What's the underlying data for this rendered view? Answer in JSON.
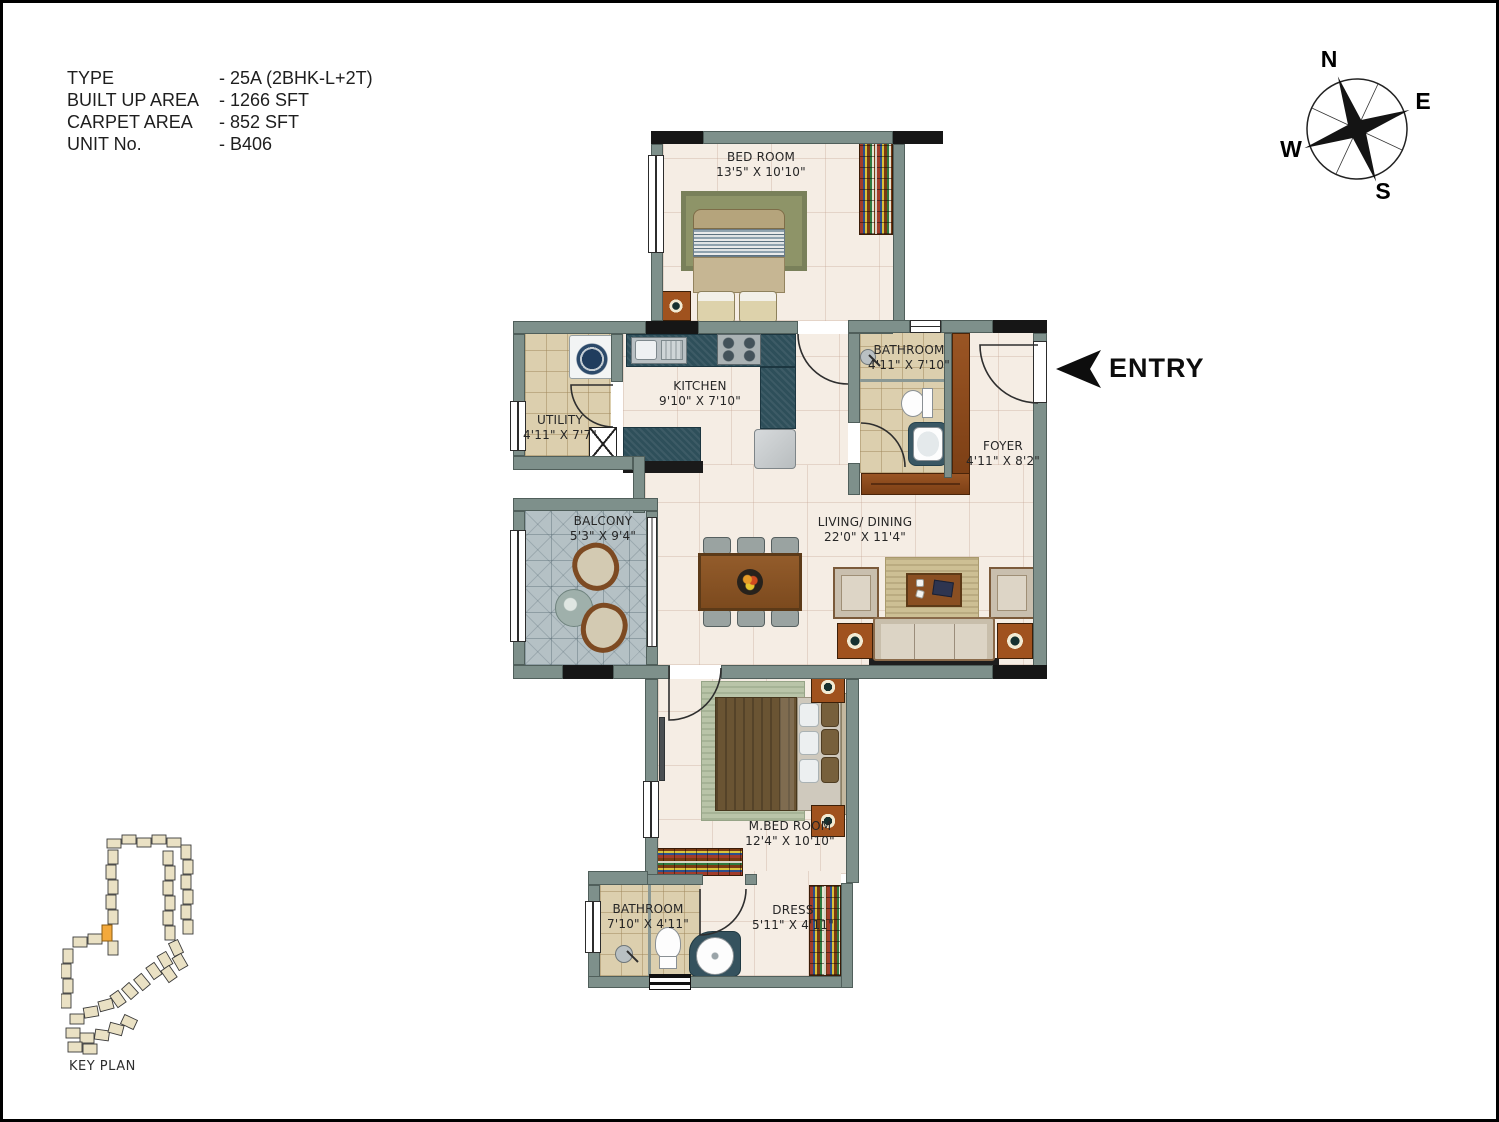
{
  "unit_info": {
    "rows": [
      {
        "label": "TYPE",
        "value": "- 25A (2BHK-L+2T)"
      },
      {
        "label": "BUILT UP AREA",
        "value": "- 1266 SFT"
      },
      {
        "label": "CARPET AREA",
        "value": "- 852 SFT"
      },
      {
        "label": "UNIT No.",
        "value": "- B406"
      }
    ]
  },
  "compass": {
    "north": "N",
    "east": "E",
    "west": "W",
    "south": "S"
  },
  "entry": {
    "label": "ENTRY"
  },
  "key_plan": {
    "label": "KEY PLAN"
  },
  "rooms": [
    {
      "id": "bedroom",
      "name": "BED ROOM",
      "dims": "13'5\" X 10'10\""
    },
    {
      "id": "kitchen",
      "name": "KITCHEN",
      "dims": "9'10\" X 7'10\""
    },
    {
      "id": "utility",
      "name": "UTILITY",
      "dims": "4'11\" X 7'7\""
    },
    {
      "id": "bathroom-top",
      "name": "BATHROOM",
      "dims": "4'11\" X 7'10\""
    },
    {
      "id": "foyer",
      "name": "FOYER",
      "dims": "4'11\" X 8'2\""
    },
    {
      "id": "balcony",
      "name": "BALCONY",
      "dims": "5'3\" X 9'4\""
    },
    {
      "id": "living-dining",
      "name": "LIVING/ DINING",
      "dims": "22'0\" X 11'4\""
    },
    {
      "id": "master-bedroom",
      "name": "M.BED ROOM",
      "dims": "12'4\" X 10'10\""
    },
    {
      "id": "bathroom-bottom",
      "name": "BATHROOM",
      "dims": "7'10\" X 4'11\""
    },
    {
      "id": "dress",
      "name": "DRESS",
      "dims": "5'11\" X 4'11\""
    }
  ],
  "colors": {
    "wall": "#7e908b",
    "wall_dark": "#161616",
    "floor": "#f5ede4",
    "tile_bath": "#dccfae",
    "tile_balcony": "#b5c1c5",
    "counter": "#2e4f5a",
    "wood": "#8a4a1e",
    "highlight_unit": "#f3a93c"
  }
}
